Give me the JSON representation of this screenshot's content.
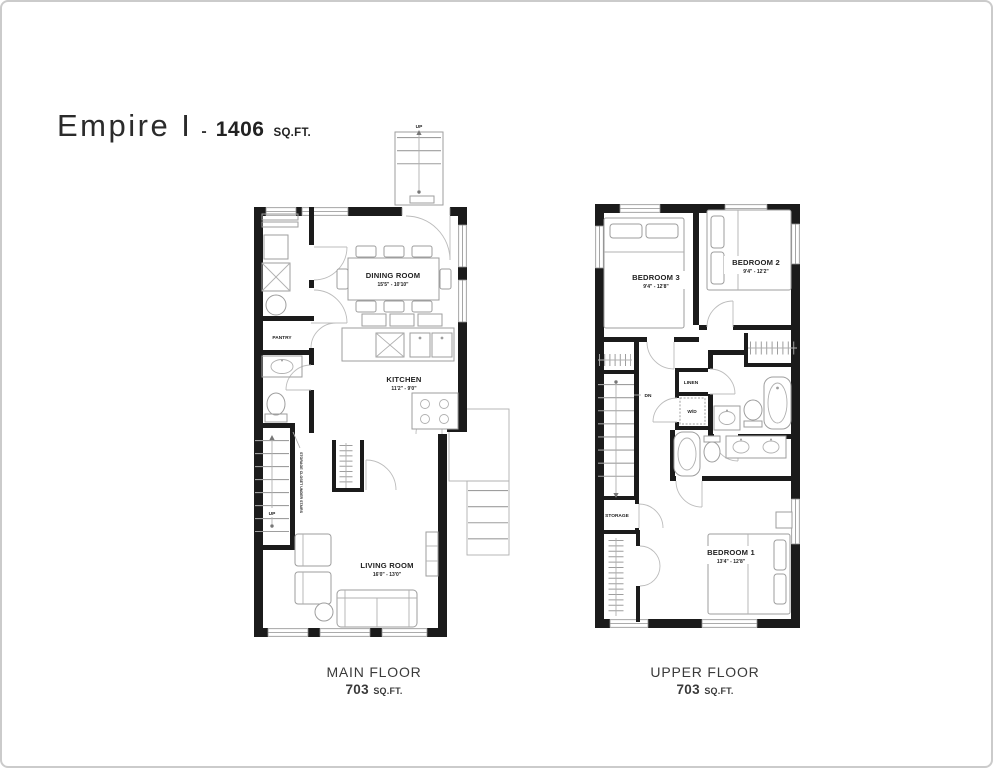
{
  "header": {
    "model_name": "Empire I",
    "separator": "-",
    "total_area": "1406",
    "total_area_unit": "SQ.FT."
  },
  "main_floor": {
    "caption_line1": "MAIN FLOOR",
    "caption_area": "703",
    "caption_unit": "SQ.FT.",
    "rooms": {
      "dining": {
        "label": "DINING ROOM",
        "dims": "15'5\" - 10'10\""
      },
      "kitchen": {
        "label": "KITCHEN",
        "dims": "11'2\" - 9'0\""
      },
      "living": {
        "label": "LIVING ROOM",
        "dims": "16'0\" - 13'0\""
      },
      "pantry": {
        "label": "PANTRY"
      },
      "storage_under_stairs": {
        "label": "STORAGE CLOSET UNDER STAIRS"
      }
    },
    "stair_labels": {
      "front_up": "UP",
      "interior_up": "UP"
    }
  },
  "upper_floor": {
    "caption_line1": "UPPER FLOOR",
    "caption_area": "703",
    "caption_unit": "SQ.FT.",
    "rooms": {
      "bedroom3": {
        "label": "BEDROOM 3",
        "dims": "9'4\" - 12'8\""
      },
      "bedroom2": {
        "label": "BEDROOM 2",
        "dims": "9'4\" - 12'2\""
      },
      "bedroom1": {
        "label": "BEDROOM 1",
        "dims": "13'4\" - 12'8\""
      },
      "linen": {
        "label": "LINEN"
      },
      "laundry": {
        "label": "W/D"
      },
      "storage": {
        "label": "STORAGE"
      }
    },
    "stair_labels": {
      "dn": "DN"
    }
  },
  "colors": {
    "wall": "#1b1b1b",
    "furniture_line": "#9e9e9e",
    "text": "#222222",
    "frame": "#cbcbcb"
  }
}
